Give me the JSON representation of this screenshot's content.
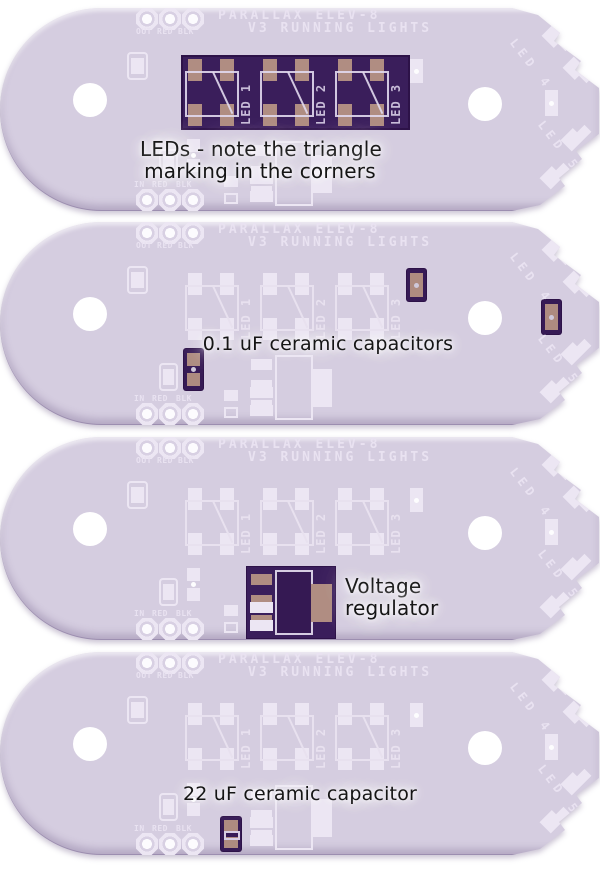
{
  "page": {
    "background_color": "#ffffff"
  },
  "board": {
    "silkscreen_title_line1": "PARALLAX ELEV-8",
    "silkscreen_title_line2": "V3 RUNNING LIGHTS",
    "top_header_labels": [
      "OUT",
      "RED",
      "BLK"
    ],
    "bottom_header_labels": [
      "IN",
      "RED",
      "BLK"
    ],
    "led_labels": [
      "LED 1",
      "LED 2",
      "LED 3"
    ],
    "edge_led_labels": [
      "LED 4",
      "LED 5"
    ],
    "colors": {
      "board": "#d5cde0",
      "silkscreen": "#ece6f3",
      "highlight_purple": "#3a1e5b",
      "pad_tan": "#b08d82",
      "mounting_hole": "#ffffff",
      "caption_text": "#151515"
    }
  },
  "panels": [
    {
      "highlight": "leds",
      "caption": "LEDs - note the triangle\nmarking in the corners"
    },
    {
      "highlight": "caps01",
      "caption": "0.1 uF ceramic capacitors"
    },
    {
      "highlight": "vreg",
      "caption": "Voltage\nregulator"
    },
    {
      "highlight": "cap22",
      "caption": "22 uF ceramic capacitor"
    }
  ]
}
